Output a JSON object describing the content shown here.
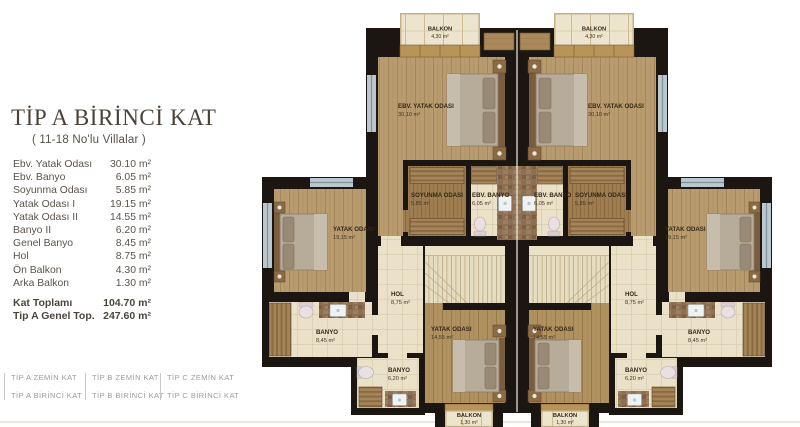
{
  "panel": {
    "title": "TİP A BİRİNCİ KAT",
    "subtitle": "( 11-18 No'lu Villalar )",
    "rooms": [
      {
        "label": "Ebv. Yatak Odası",
        "area": "30.10 m²"
      },
      {
        "label": "Ebv. Banyo",
        "area": "6.05 m²"
      },
      {
        "label": "Soyunma Odası",
        "area": "5.85 m²"
      },
      {
        "label": "Yatak Odası I",
        "area": "19.15 m²"
      },
      {
        "label": "Yatak Odası II",
        "area": "14.55 m²"
      },
      {
        "label": "Banyo II",
        "area": "6.20 m²"
      },
      {
        "label": "Genel Banyo",
        "area": "8.45 m²"
      },
      {
        "label": "Hol",
        "area": "8.75 m²"
      },
      {
        "label": "Ön Balkon",
        "area": "4.30 m²"
      },
      {
        "label": "Arka Balkon",
        "area": "1.30 m²"
      }
    ],
    "totals": [
      {
        "label": "Kat Toplamı",
        "area": "104.70 m²"
      },
      {
        "label": "Tip A Genel Top.",
        "area": "247.60 m²"
      }
    ]
  },
  "nav": {
    "items": [
      "TİP A ZEMİN KAT",
      "TİP A BİRİNCİ KAT",
      "TİP B ZEMİN KAT",
      "TİP B BİRİNCİ KAT",
      "TİP C ZEMİN KAT",
      "TİP C BİRİNCİ KAT"
    ]
  },
  "plan": {
    "labels": {
      "balkon_on": {
        "name": "BALKON",
        "area": "4,30 m²"
      },
      "ebv_yatak": {
        "name": "EBV. YATAK ODASI",
        "area": "30,10 m²"
      },
      "soyunma": {
        "name": "SOYUNMA ODASI",
        "area": "5,85 m²"
      },
      "ebv_banyo": {
        "name": "EBV. BANYO",
        "area": "6,05 m²"
      },
      "yatak1": {
        "name": "YATAK ODASI",
        "area": "19,15 m²"
      },
      "hol": {
        "name": "HOL",
        "area": "8,75 m²"
      },
      "genel_banyo": {
        "name": "BANYO",
        "area": "8,45 m²"
      },
      "yatak2": {
        "name": "YATAK ODASI",
        "area": "14,55 m²"
      },
      "banyo2": {
        "name": "BANYO",
        "area": "6,20 m²"
      },
      "balkon_arka": {
        "name": "BALKON",
        "area": "1,30 m²"
      }
    },
    "colors": {
      "wall": "#1b1611",
      "wood_floor": "#b89b6f",
      "wood_floor_dark": "#9e7e50",
      "tile_floor": "#eae1c8",
      "balcony": "#ece4cd",
      "stairs": "#e6dcc0",
      "label_text": "#34281a",
      "title_text": "#4a423a",
      "nav_text": "#9b9b9b",
      "window": "#bcc7cd"
    }
  }
}
